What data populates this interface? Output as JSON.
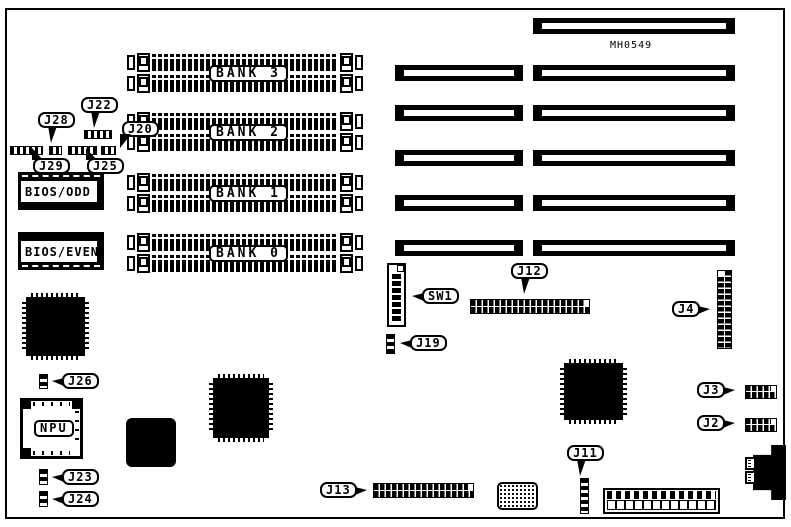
{
  "board": {
    "part_number": "MH0549",
    "memory_banks": [
      "BANK 3",
      "BANK 2",
      "BANK 1",
      "BANK 0"
    ],
    "chips": {
      "bios_odd": "BIOS/ODD",
      "bios_even": "BIOS/EVEN",
      "npu": "NPU"
    },
    "callouts": {
      "j28": "J28",
      "j22": "J22",
      "j20": "J20",
      "j29": "J29",
      "j25": "J25",
      "sw1": "SW1",
      "j12": "J12",
      "j19": "J19",
      "j4": "J4",
      "j26": "J26",
      "j23": "J23",
      "j24": "J24",
      "j13": "J13",
      "j11": "J11",
      "j3": "J3",
      "j2": "J2"
    },
    "colors": {
      "ink": "#000000",
      "paper": "#ffffff"
    }
  }
}
